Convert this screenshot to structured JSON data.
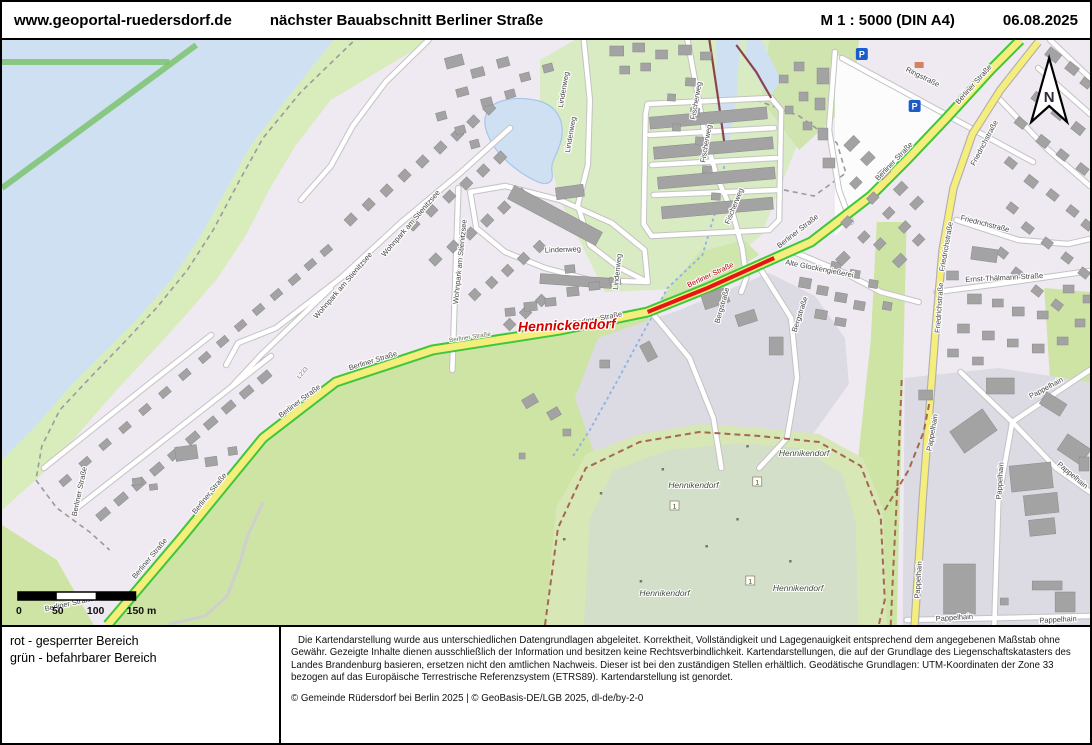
{
  "header": {
    "site": "www.geoportal-ruedersdorf.de",
    "title": "nächster Bauabschnitt Berliner Straße",
    "scale": "M 1 : 5000 (DIN A4)",
    "date": "06.08.2025"
  },
  "legend": {
    "line1": "rot - gesperrter Bereich",
    "line2": "grün - befahrbarer Bereich"
  },
  "footer": {
    "disclaimer": "Die Kartendarstellung wurde aus unterschiedlichen Datengrundlagen abgeleitet. Korrektheit, Vollständigkeit und Lagegenauigkeit entsprechend dem angegebenen Maßstab ohne Gewähr. Gezeigte Inhalte dienen ausschließlich der Information und besitzen keine Rechtsverbindlichkeit. Kartendarstellungen, die auf der Grundlage des Liegenschaftskatasters des Landes Brandenburg basieren, ersetzen nicht den amtlichen Nachweis. Dieser ist bei den zuständigen Stellen erhältlich. Geodätische Grundlagen: UTM-Koordinaten der Zone 33 bezogen auf das Europäische Terrestrische Referenzsystem (ETRS89). Kartendarstellung ist genordet.",
    "copyright": "© Gemeinde Rüdersdorf bei Berlin 2025 | © GeoBasis-DE/LGB 2025, dl-de/by-2-0"
  },
  "map": {
    "north_letter": "N",
    "parking_letter": "P",
    "scalebar": {
      "t0": "0",
      "t50": "50",
      "t100": "100",
      "t150": "150 m"
    },
    "colors": {
      "blocked_red": "#e81515",
      "drivable_green": "#3fc73c",
      "road_yellow": "#f6ee7c",
      "water": "#cfe0f2",
      "residential": "#efe9f2",
      "grass": "#cde4a5",
      "forest": "#d4dfc9",
      "industrial": "#dcdae3",
      "parking_blue": "#1a5cc8"
    },
    "markers": [
      {
        "t": "1",
        "x": 675,
        "y": 466
      },
      {
        "t": "1",
        "x": 758,
        "y": 442
      },
      {
        "t": "1",
        "x": 751,
        "y": 541
      }
    ],
    "labels": [
      {
        "t": "Berliner Straße",
        "x": 150,
        "y": 520,
        "r": -50,
        "c": "road"
      },
      {
        "t": "Berliner Straße",
        "x": 210,
        "y": 455,
        "r": -51,
        "c": "road"
      },
      {
        "t": "Berliner Straße",
        "x": 300,
        "y": 363,
        "r": -37,
        "c": "road"
      },
      {
        "t": "Berliner Straße",
        "x": 373,
        "y": 323,
        "r": -17,
        "c": "road"
      },
      {
        "t": "Berliner Straße",
        "x": 470,
        "y": 299,
        "r": -9,
        "c": "roadsm"
      },
      {
        "t": "Berliner Straße",
        "x": 598,
        "y": 281,
        "r": -11,
        "c": "road"
      },
      {
        "t": "Berliner Straße",
        "x": 712,
        "y": 237,
        "r": -25,
        "c": "roadred"
      },
      {
        "t": "Berliner Straße",
        "x": 800,
        "y": 193,
        "r": -38,
        "c": "road"
      },
      {
        "t": "Berliner Straße",
        "x": 897,
        "y": 123,
        "r": -46,
        "c": "road"
      },
      {
        "t": "Berliner Straße",
        "x": 977,
        "y": 46,
        "r": -48,
        "c": "road"
      },
      {
        "t": "Berliner Straße",
        "x": 68,
        "y": 566,
        "r": -12,
        "c": "road"
      },
      {
        "t": "Berliner Straße",
        "x": 80,
        "y": 452,
        "r": -78,
        "c": "road"
      },
      {
        "t": "Ringstraße",
        "x": 923,
        "y": 39,
        "r": 26,
        "c": "road"
      },
      {
        "t": "Friedrichstraße",
        "x": 950,
        "y": 207,
        "r": -80,
        "c": "road"
      },
      {
        "t": "Friedrichstraße",
        "x": 943,
        "y": 268,
        "r": -86,
        "c": "road"
      },
      {
        "t": "Friedrichstraße",
        "x": 986,
        "y": 186,
        "r": 14,
        "c": "road"
      },
      {
        "t": "Friedrichstraße",
        "x": 988,
        "y": 104,
        "r": -62,
        "c": "road"
      },
      {
        "t": "Ernst-Thälmann-Straße",
        "x": 1006,
        "y": 240,
        "r": -3,
        "c": "road"
      },
      {
        "t": "Pappelhain",
        "x": 936,
        "y": 393,
        "r": -80,
        "c": "road"
      },
      {
        "t": "Pappelhain",
        "x": 1004,
        "y": 441,
        "r": -86,
        "c": "road"
      },
      {
        "t": "Pappelhain",
        "x": 922,
        "y": 540,
        "r": -86,
        "c": "road"
      },
      {
        "t": "Pappelhain",
        "x": 1073,
        "y": 437,
        "r": 40,
        "c": "road"
      },
      {
        "t": "Pappelhain",
        "x": 956,
        "y": 580,
        "r": -4,
        "c": "road"
      },
      {
        "t": "Pappelhain",
        "x": 1060,
        "y": 582,
        "r": -3,
        "c": "road"
      },
      {
        "t": "Pappelhain",
        "x": 1049,
        "y": 350,
        "r": -28,
        "c": "road"
      },
      {
        "t": "Wohnpark am Stienitzsee",
        "x": 412,
        "y": 185,
        "r": -49,
        "c": "road"
      },
      {
        "t": "Wohnpark am Stienitzsee",
        "x": 462,
        "y": 222,
        "r": -84,
        "c": "road"
      },
      {
        "t": "Wohnpark am Stienitzsee",
        "x": 344,
        "y": 247,
        "r": -49,
        "c": "road"
      },
      {
        "t": "Lindenweg",
        "x": 566,
        "y": 50,
        "r": -80,
        "c": "road"
      },
      {
        "t": "Lindenweg",
        "x": 573,
        "y": 95,
        "r": -80,
        "c": "road"
      },
      {
        "t": "Lindenweg",
        "x": 563,
        "y": 212,
        "r": -2,
        "c": "road"
      },
      {
        "t": "Lindenweg",
        "x": 620,
        "y": 232,
        "r": -84,
        "c": "road"
      },
      {
        "t": "Fischerweg",
        "x": 699,
        "y": 61,
        "r": -80,
        "c": "road"
      },
      {
        "t": "Fischerweg",
        "x": 709,
        "y": 104,
        "r": -80,
        "c": "road"
      },
      {
        "t": "Fischerweg",
        "x": 737,
        "y": 167,
        "r": -68,
        "c": "road"
      },
      {
        "t": "Alte Glockengießerei",
        "x": 820,
        "y": 231,
        "r": 11,
        "c": "road"
      },
      {
        "t": "Bergstraße",
        "x": 725,
        "y": 266,
        "r": -74,
        "c": "road"
      },
      {
        "t": "Bergstraße",
        "x": 803,
        "y": 275,
        "r": -72,
        "c": "road"
      },
      {
        "t": "L233",
        "x": 303,
        "y": 334,
        "r": -50,
        "c": "ref"
      },
      {
        "t": "Hennickendorf",
        "x": 567,
        "y": 290,
        "r": -2,
        "c": "town"
      },
      {
        "t": "Hennikendorf",
        "x": 694,
        "y": 448,
        "r": 0,
        "c": "forest"
      },
      {
        "t": "Hennikendorf",
        "x": 805,
        "y": 416,
        "r": 0,
        "c": "forest"
      },
      {
        "t": "Hennikendorf",
        "x": 665,
        "y": 556,
        "r": 0,
        "c": "forest"
      },
      {
        "t": "Hennikendorf",
        "x": 799,
        "y": 551,
        "r": 0,
        "c": "forest"
      }
    ]
  }
}
